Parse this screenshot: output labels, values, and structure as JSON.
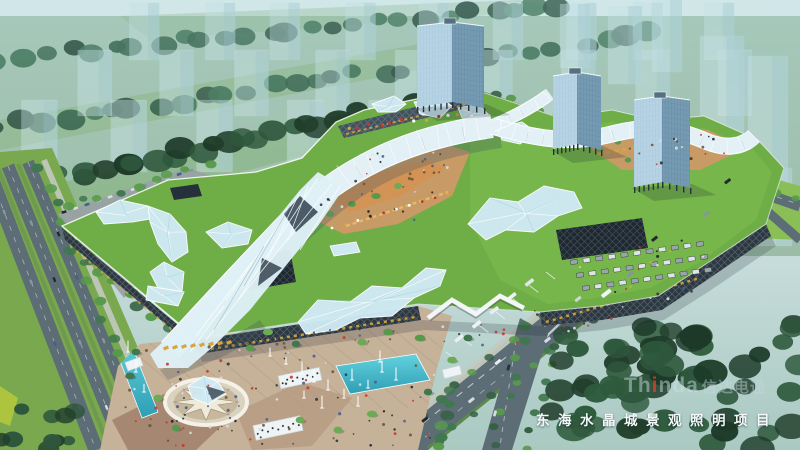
{
  "caption": {
    "text": "东海水晶城景观照明项目"
  },
  "watermark": {
    "en_pre": "Th",
    "en_accent": "i",
    "en_post": "nda",
    "cn": "信达电通"
  },
  "colors": {
    "sky_top": "#eef6f7",
    "sky_mid": "#cfe2e2",
    "sky_low": "#a9c9c1",
    "ghost": "#d9edf2",
    "tree_dark": "#223f2c",
    "tree_mid": "#2e573c",
    "tree_light": "#40774e",
    "foliage": "#579a4b",
    "lawn": "#8abf57",
    "roof": "#6fae46",
    "roof2": "#7cba4f",
    "road": "#5c6d76",
    "road2": "#73838c",
    "walk": "#c3c9c0",
    "facade": "#2c3841",
    "facade2": "#41525e",
    "crystal": "#cfe9f3",
    "crystal2": "#9fcfe2",
    "ribbon": "#e3f0f6",
    "gold": "#d9a43e",
    "tan": "#c6b199",
    "tan2": "#a0806a",
    "water": "#41b7c9",
    "tower_light": "#aecde0",
    "tower_dark": "#6e95ae",
    "white": "#ffffff",
    "ink": "#20262c",
    "red": "#d73a28"
  }
}
